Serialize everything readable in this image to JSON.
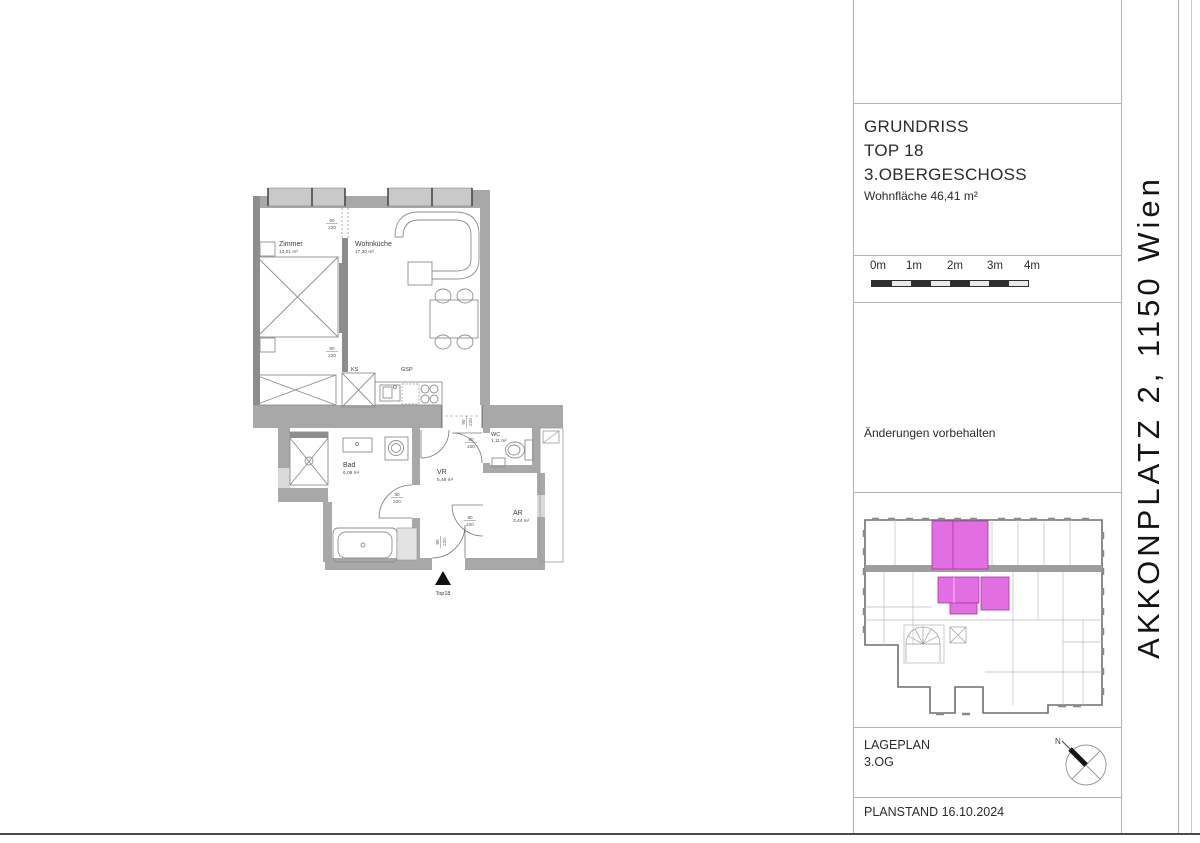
{
  "title_block": {
    "title_line1": "GRUNDRISS",
    "title_line2": "TOP 18",
    "title_line3": "3.OBERGESCHOSS",
    "area_label": "Wohnfläche 46,41 m²",
    "scale_labels": [
      "0m",
      "1m",
      "2m",
      "3m",
      "4m"
    ],
    "note": "Änderungen vorbehalten",
    "lageplan_label": "LAGEPLAN",
    "lageplan_floor": "3.OG",
    "planstand": "PLANSTAND 16.10.2024",
    "compass_north": "N"
  },
  "address_strip": {
    "text": "AKKONPLATZ 2, 1150 Wien"
  },
  "floorplan": {
    "rooms": {
      "zimmer": {
        "name": "Zimmer",
        "area": "13,01 m²"
      },
      "wohnkueche": {
        "name": "Wohnküche",
        "area": "17,30 m²"
      },
      "bad": {
        "name": "Bad",
        "area": "6,09 m²"
      },
      "vr": {
        "name": "VR",
        "area": "5,46 m²"
      },
      "wc": {
        "name": "WC",
        "area": "1,11 m²"
      },
      "ar": {
        "name": "AR",
        "area": "3,44 m²"
      }
    },
    "kitchen": {
      "fridge_label": "KS",
      "dishwasher_label": "GSP"
    },
    "entrance": {
      "unit_label": "Top18"
    },
    "dims": {
      "partition_top": {
        "w": "60",
        "h": "220"
      },
      "partition_mid": {
        "w": "80",
        "h": "220"
      },
      "wc_door": {
        "w": "80",
        "h": "220"
      },
      "bad_door": {
        "w": "80",
        "h": "220"
      },
      "ar_door": {
        "w": "80",
        "h": "220"
      },
      "entrance_door": {
        "w": "90",
        "h": "220"
      },
      "portal": {
        "w": "90",
        "h": "220"
      }
    }
  },
  "colors": {
    "highlight": "#e26fe2",
    "highlight_border": "#a832a8"
  }
}
